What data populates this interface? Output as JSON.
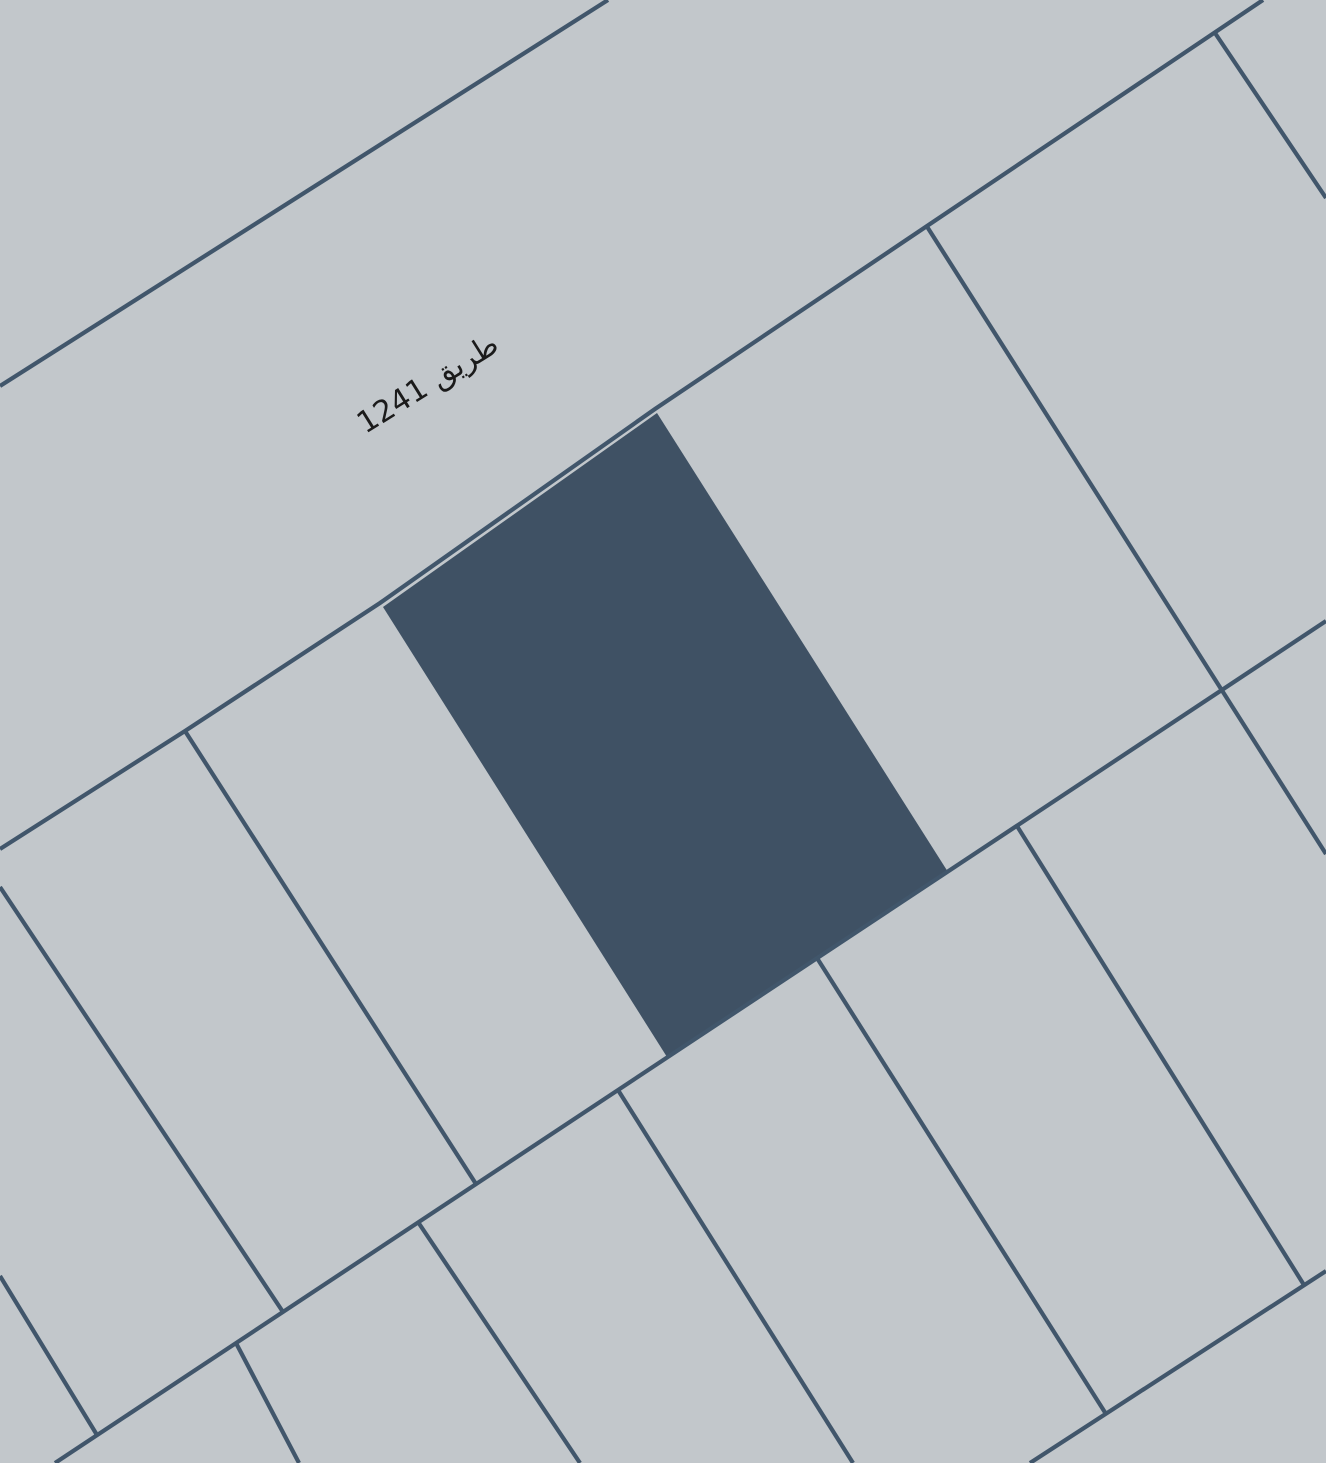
{
  "map": {
    "kind": "cadastral-parcel-map",
    "width": 1326,
    "height": 1463,
    "colors": {
      "background": "#c2c7cb",
      "parcel_line": "#41566b",
      "selected_parcel_fill": "#3f5164",
      "label_text": "#1b1b1b"
    },
    "line_width": 4.2,
    "label": {
      "text": "طريق 1241",
      "x": 433,
      "y": 392,
      "rotation_deg": -32,
      "font_size": 30
    },
    "selected_parcel": {
      "points": [
        [
          657,
          413
        ],
        [
          948,
          872
        ],
        [
          667,
          1057
        ],
        [
          383,
          607
        ]
      ]
    },
    "lines": [
      {
        "name": "road-nw-edge",
        "points": [
          [
            608,
            0
          ],
          [
            0,
            386
          ]
        ]
      },
      {
        "name": "road-se-edge",
        "points": [
          [
            1263,
            0
          ],
          [
            655,
            409
          ],
          [
            380,
            603
          ],
          [
            185,
            731
          ],
          [
            0,
            849
          ]
        ]
      },
      {
        "name": "block-boundary-middle",
        "points": [
          [
            55,
            1463
          ],
          [
            1326,
            621
          ]
        ]
      },
      {
        "name": "block-boundary-bottom",
        "points": [
          [
            1030,
            1463
          ],
          [
            1326,
            1271
          ]
        ]
      },
      {
        "name": "divider-top-right",
        "points": [
          [
            1215,
            33
          ],
          [
            1326,
            198
          ]
        ]
      },
      {
        "name": "divider-long-right",
        "points": [
          [
            926,
            225
          ],
          [
            1326,
            854
          ]
        ]
      },
      {
        "name": "divider-row1-left-edge",
        "points": [
          [
            0,
            1276
          ],
          [
            97,
            1435
          ]
        ]
      },
      {
        "name": "divider-row1-a",
        "points": [
          [
            0,
            887
          ],
          [
            283,
            1312
          ]
        ]
      },
      {
        "name": "divider-row1-b",
        "points": [
          [
            185,
            731
          ],
          [
            476,
            1184
          ]
        ]
      },
      {
        "name": "divider-row2-a",
        "points": [
          [
            236,
            1343
          ],
          [
            299,
            1463
          ]
        ]
      },
      {
        "name": "divider-row2-b",
        "points": [
          [
            418,
            1222
          ],
          [
            580,
            1463
          ]
        ]
      },
      {
        "name": "divider-row2-c",
        "points": [
          [
            618,
            1090
          ],
          [
            853,
            1463
          ]
        ]
      },
      {
        "name": "divider-row2-d",
        "points": [
          [
            817,
            958
          ],
          [
            1106,
            1414
          ]
        ]
      },
      {
        "name": "divider-row2-e",
        "points": [
          [
            1017,
            826
          ],
          [
            1304,
            1285
          ]
        ]
      }
    ]
  }
}
